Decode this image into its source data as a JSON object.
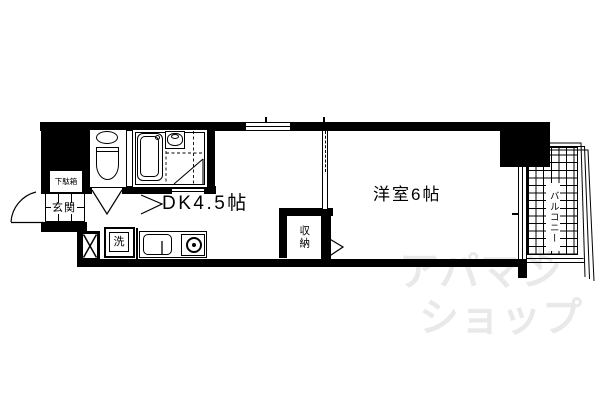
{
  "plan": {
    "labels": {
      "dk": "DK4.5帖",
      "western_room": "洋室6帖",
      "closet": "収納",
      "balcony": "バルコニー",
      "entrance": "玄関",
      "shoe_cabinet": "下駄箱",
      "washer": "洗"
    },
    "watermark": {
      "line1": "アパマン",
      "mark": "ド",
      "line2": "ショップ"
    },
    "colors": {
      "line": "#000000",
      "background": "#ffffff",
      "watermark": "#e9e9e9"
    }
  }
}
